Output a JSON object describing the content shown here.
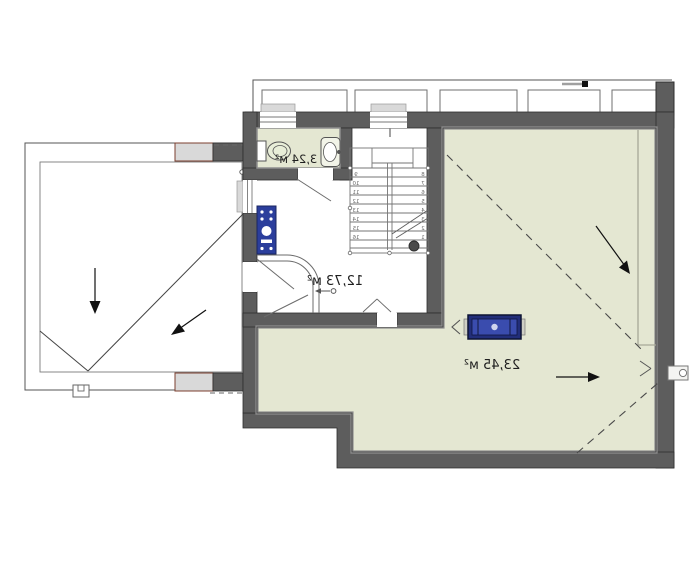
{
  "plan": {
    "type": "mirrored-floor-plan",
    "rooms": {
      "bathroom": {
        "area": "3,24 м²"
      },
      "hall": {
        "area": "12,73 м²"
      },
      "main": {
        "area": "23,45 м²"
      }
    },
    "stairs": {
      "left_numbers": [
        "9",
        "10",
        "11",
        "12",
        "13",
        "14",
        "15",
        "16"
      ],
      "right_numbers": [
        "8",
        "7",
        "6",
        "5",
        "4",
        "3",
        "2",
        "1"
      ],
      "top_tick": "5"
    },
    "fixtures": [
      "toilet",
      "washbasin",
      "boiler",
      "roof-window",
      "gutter-outlet",
      "drain-scupper"
    ],
    "annotations": {
      "slope_arrows": 4,
      "dashed_ridge_lines": 2
    },
    "colors": {
      "floor_green": "#e4e7d2",
      "wall_gray": "#5d5d5d",
      "wall_inner_edge": "#8f8f8f",
      "boiler_blue": "#2b3e9c",
      "roof_window_blue": "#222e7a",
      "attachment_fill": "#d9d9d9",
      "attachment_border": "#7c3f2f",
      "line_dark": "#3c3c3c"
    }
  }
}
